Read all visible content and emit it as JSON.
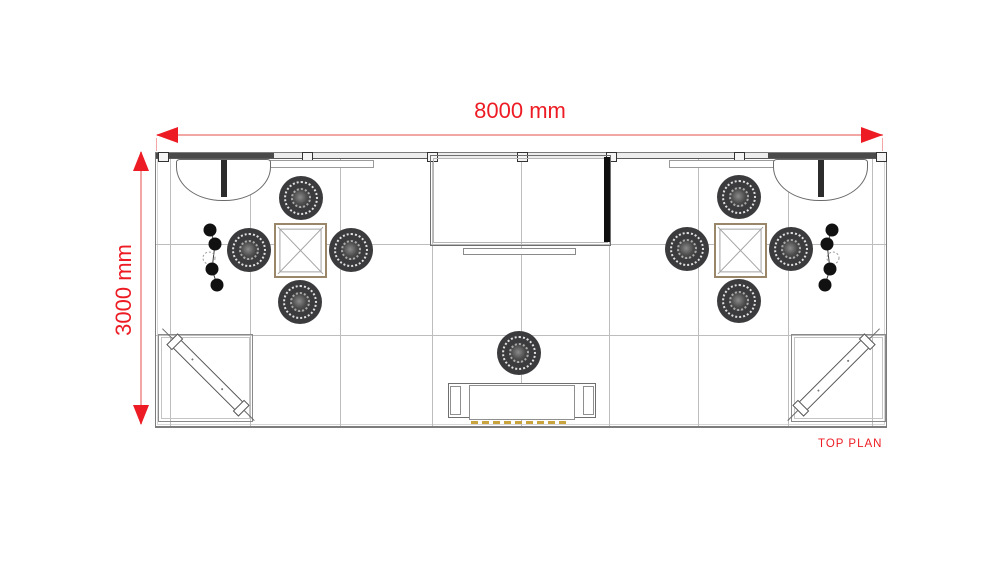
{
  "labels": {
    "width_dimension": "8000 mm",
    "height_dimension": "3000 mm",
    "caption": "TOP PLAN"
  },
  "colors": {
    "accent_red": "#ed1c24",
    "dimension_line": "#f2a7a5",
    "drawing_line": "#8c8c8c",
    "wall_fill": "#4a4a4a",
    "door_fill": "#0f0f0f",
    "table_border": "#9a8668",
    "chair_fill": "#3b3b3d",
    "led_strip": "#c9a43e"
  },
  "plan": {
    "width_mm": 8000,
    "height_mm": 3000,
    "grid": {
      "verticals": [
        14,
        94,
        184,
        276,
        365,
        453,
        542,
        632,
        716
      ],
      "horizontals": [
        91,
        182
      ]
    },
    "wall": {
      "dark_segments": [
        {
          "x": 0,
          "w": 118
        },
        {
          "x": 612,
          "w": 118
        }
      ],
      "joints": [
        2,
        146,
        271,
        361,
        450,
        578,
        720
      ],
      "panels": [
        {
          "x": 103,
          "w": 113
        },
        {
          "x": 513,
          "w": 110
        }
      ]
    },
    "curved_counters": [
      {
        "x": 20,
        "w": 93
      },
      {
        "x": 617,
        "w": 93
      }
    ],
    "central_room": {
      "x": 274,
      "y": 2,
      "w": 179,
      "h": 89,
      "door": {
        "x": 448,
        "y": 4,
        "w": 6,
        "h": 85
      },
      "shelf": {
        "x": 307,
        "y": 95,
        "w": 111,
        "h": 5
      }
    },
    "meeting_tables": [
      {
        "x": 118,
        "y": 70,
        "w": 49,
        "h": 51
      },
      {
        "x": 558,
        "y": 70,
        "w": 49,
        "h": 51
      }
    ],
    "chairs": [
      [
        145,
        45
      ],
      [
        93,
        97
      ],
      [
        195,
        97
      ],
      [
        144,
        149
      ],
      [
        583,
        44
      ],
      [
        531,
        96
      ],
      [
        635,
        96
      ],
      [
        583,
        148
      ],
      [
        363,
        200
      ]
    ],
    "corner_rooms": [
      {
        "x": 2,
        "y": 181,
        "w": 93,
        "h": 86,
        "bench": {
          "cx": 52,
          "cy": 222,
          "angle": 45
        }
      },
      {
        "x": 635,
        "y": 181,
        "w": 93,
        "h": 86,
        "bench": {
          "cx": 678,
          "cy": 222,
          "angle": -45
        }
      }
    ],
    "pendant_chains": [
      {
        "x": 44,
        "y": 66,
        "mirror": false
      },
      {
        "x": 654,
        "y": 66,
        "mirror": true
      }
    ],
    "reception_counter": {
      "x": 292,
      "y": 230,
      "w": 146,
      "h": 33,
      "led": {
        "x": 315,
        "y": 268,
        "w": 98,
        "h": 3
      }
    }
  }
}
